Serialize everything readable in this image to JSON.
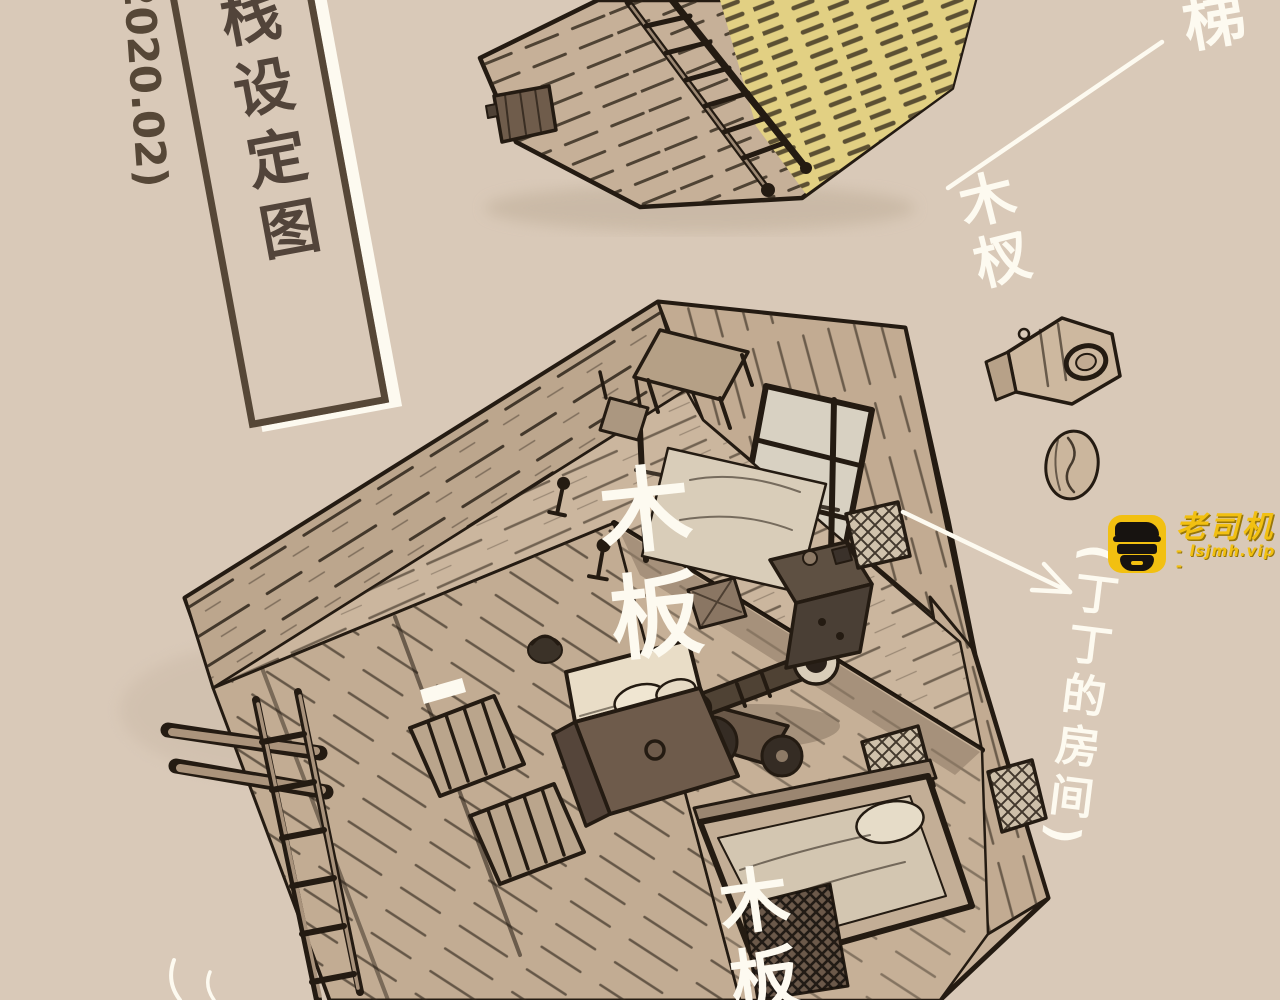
{
  "page": {
    "background": "#d9c9b8"
  },
  "title_block": {
    "title": "客栈设定图",
    "date": "(2020.02)",
    "ink": "#54463b",
    "outline": "#fdfaf0"
  },
  "annotations": {
    "ink": "#fdfaf0",
    "stairs_label": "楼梯",
    "wood_fork_label": "木杈",
    "plank_label": "木板",
    "plank_label_bottom": "木板",
    "room_label": "(丁丁的房间)"
  },
  "watermark": {
    "brand": "老司机",
    "site": "- lsjmh.vip -",
    "icon": "driver-avatar-icon",
    "colors": {
      "yellow": "#f2c011",
      "ink": "#171310"
    }
  },
  "palette": {
    "background": "#d9c9b8",
    "sketch_ink": "#241b12",
    "wood": "#c7b199",
    "wood_dark": "#a08b74",
    "straw": "#e2d083",
    "white_ink": "#fdfaf0",
    "title_ink": "#564737"
  }
}
